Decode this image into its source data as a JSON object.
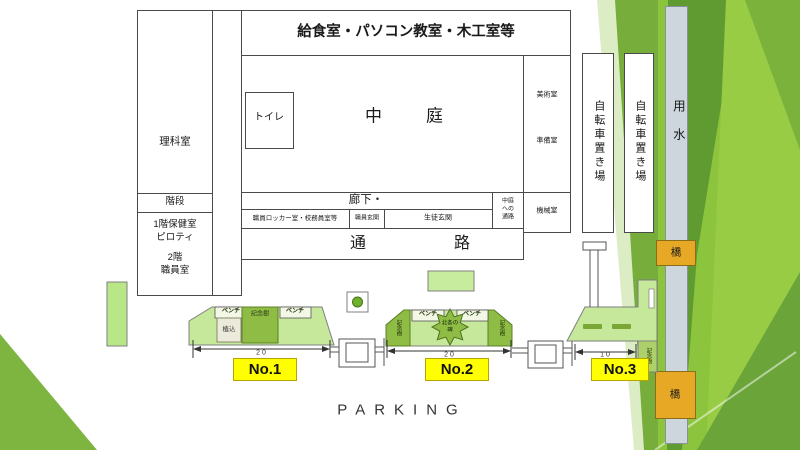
{
  "slide": {
    "parking_title": "PARKING"
  },
  "building": {
    "banner": "給食室・パソコン教室・木工室等",
    "science_room": "理科室",
    "stairs": "階段",
    "wing_line1": "1階保健室",
    "wing_line2": "ピロティ",
    "wing_line3": "2階",
    "wing_line4": "職員室",
    "toilet": "トイレ",
    "courtyard": "中庭",
    "corridor": "廊下・",
    "staff_locker": "職員ロッカー室・校務員室等",
    "staff_entrance": "職員玄関",
    "student_entrance": "生徒玄関",
    "courtyard_passage_l1": "中庭",
    "courtyard_passage_l2": "への",
    "courtyard_passage_l3": "通路",
    "machine_room": "機械室",
    "passage": "通路",
    "art_room": "美術室",
    "prep_room": "準備室"
  },
  "outdoor": {
    "bicycle_shed": "自転車置き場",
    "water_channel": "用水",
    "bridge": "橋"
  },
  "parking": {
    "bench": "ベンチ",
    "memorial_tree": "記念樹",
    "shrub": "植込",
    "monument_l1": "北条の",
    "monument_l2": "碑",
    "sections": [
      {
        "label": "No.1",
        "width": "20"
      },
      {
        "label": "No.2",
        "width": "20"
      },
      {
        "label": "No.3",
        "width": "10"
      }
    ]
  },
  "colors": {
    "accent_green": "#8cc43e",
    "parking_fill": "#c6e89b",
    "dark_green_box": "#8fbc45",
    "label_yellow": "#ffff00",
    "bridge_orange": "#e7a826",
    "water_gray": "#ccd6dc"
  }
}
